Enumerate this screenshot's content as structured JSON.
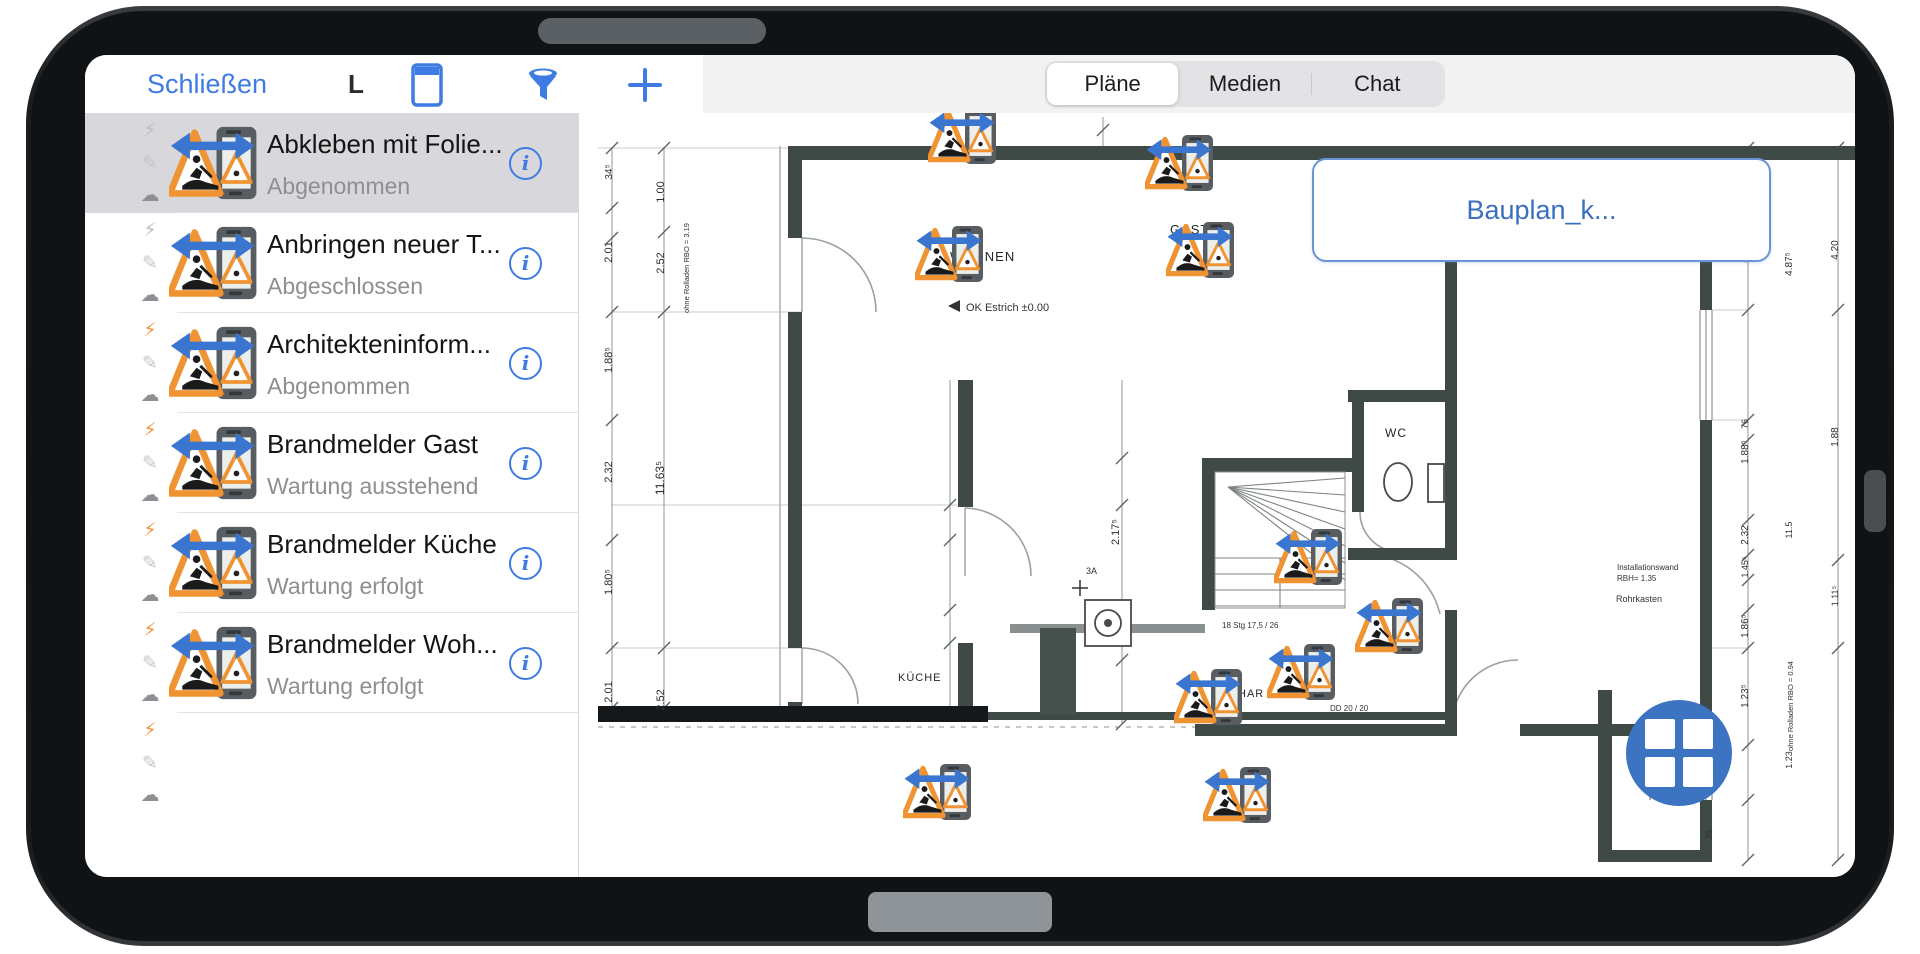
{
  "header": {
    "close_label": "Schließen",
    "context_label": "L",
    "tabs": [
      {
        "label": "Pläne",
        "selected": true
      },
      {
        "label": "Medien",
        "selected": false
      },
      {
        "label": "Chat",
        "selected": false
      }
    ]
  },
  "sidebar": {
    "items": [
      {
        "title": "Abkleben mit Folie...",
        "status": "Abgenommen",
        "selected": true,
        "flash": "gray",
        "partial": false
      },
      {
        "title": "Anbringen neuer T...",
        "status": "Abgeschlossen",
        "selected": false,
        "flash": "gray",
        "partial": false
      },
      {
        "title": "Architekteninform...",
        "status": "Abgenommen",
        "selected": false,
        "flash": "orange",
        "partial": false
      },
      {
        "title": "Brandmelder Gast",
        "status": "Wartung ausstehend",
        "selected": false,
        "flash": "orange",
        "partial": false
      },
      {
        "title": "Brandmelder Küche",
        "status": "Wartung erfolgt",
        "selected": false,
        "flash": "orange",
        "partial": false
      },
      {
        "title": "Brandmelder Woh...",
        "status": "Wartung erfolgt",
        "selected": false,
        "flash": "orange",
        "partial": false
      },
      {
        "title": "",
        "status": "",
        "selected": false,
        "flash": "orange",
        "partial": true
      }
    ]
  },
  "plan": {
    "callout_label": "Bauplan_k...",
    "room_labels": [
      {
        "t": "WOHNEN",
        "x": 950,
        "y": 261,
        "s": 13
      },
      {
        "t": "GAST",
        "x": 1170,
        "y": 234,
        "s": 13
      },
      {
        "t": "WC",
        "x": 1385,
        "y": 437,
        "s": 12
      },
      {
        "t": "KÜCHE",
        "x": 898,
        "y": 681,
        "s": 11
      },
      {
        "t": "HAR",
        "x": 1238,
        "y": 697,
        "s": 11
      }
    ],
    "annotations": [
      {
        "t": "OK Estrich ±0.00",
        "x": 966,
        "y": 311,
        "s": 11
      },
      {
        "t": "Installationswand",
        "x": 1617,
        "y": 570,
        "s": 8
      },
      {
        "t": "RBH= 1.35",
        "x": 1617,
        "y": 581,
        "s": 8
      },
      {
        "t": "Rohrkasten",
        "x": 1616,
        "y": 602,
        "s": 9
      },
      {
        "t": "DD 20 / 20",
        "x": 1330,
        "y": 711,
        "s": 8
      },
      {
        "t": "18 Stg 17,5 / 26",
        "x": 1222,
        "y": 628,
        "s": 8
      },
      {
        "t": "3A",
        "x": 1086,
        "y": 574,
        "s": 9
      }
    ],
    "dims": [
      {
        "t": "34⁵",
        "x": 612,
        "y": 172,
        "s": 10
      },
      {
        "t": "1.00",
        "x": 664,
        "y": 192,
        "s": 11
      },
      {
        "t": "2.01",
        "x": 612,
        "y": 252,
        "s": 11
      },
      {
        "t": "2.52",
        "x": 664,
        "y": 263,
        "s": 11
      },
      {
        "t": "ohne Rolladen RBO = 3.19",
        "x": 689,
        "y": 268,
        "s": 7.5
      },
      {
        "t": "1.88⁵",
        "x": 612,
        "y": 360,
        "s": 11
      },
      {
        "t": "2.32",
        "x": 612,
        "y": 472,
        "s": 11
      },
      {
        "t": "11.63⁵",
        "x": 664,
        "y": 478,
        "s": 12
      },
      {
        "t": "1.80⁵",
        "x": 612,
        "y": 582,
        "s": 11
      },
      {
        "t": "2.01",
        "x": 612,
        "y": 692,
        "s": 11
      },
      {
        "t": "2.52",
        "x": 664,
        "y": 700,
        "s": 11
      },
      {
        "t": "2.17⁵",
        "x": 1119,
        "y": 532,
        "s": 11
      },
      {
        "t": "17⁵",
        "x": 1748,
        "y": 176,
        "s": 10
      },
      {
        "t": "4.20",
        "x": 1748,
        "y": 252,
        "s": 11
      },
      {
        "t": "4.87⁵",
        "x": 1792,
        "y": 264,
        "s": 10
      },
      {
        "t": "4.20",
        "x": 1838,
        "y": 250,
        "s": 10
      },
      {
        "t": "76",
        "x": 1748,
        "y": 424,
        "s": 9
      },
      {
        "t": "1.88⁵",
        "x": 1748,
        "y": 452,
        "s": 10
      },
      {
        "t": "1.88",
        "x": 1838,
        "y": 437,
        "s": 10
      },
      {
        "t": "11.5",
        "x": 1792,
        "y": 530,
        "s": 9
      },
      {
        "t": "2.32",
        "x": 1748,
        "y": 535,
        "s": 10
      },
      {
        "t": "1.45⁵",
        "x": 1748,
        "y": 567,
        "s": 9
      },
      {
        "t": "1.86⁵",
        "x": 1748,
        "y": 626,
        "s": 10
      },
      {
        "t": "1.11⁵",
        "x": 1838,
        "y": 596,
        "s": 9
      },
      {
        "t": "1.23⁵",
        "x": 1748,
        "y": 696,
        "s": 10
      },
      {
        "t": "ohne Rolladen RBO = 0.94",
        "x": 1793,
        "y": 706,
        "s": 7.5
      },
      {
        "t": "35",
        "x": 1712,
        "y": 835,
        "s": 9
      },
      {
        "t": "1.23",
        "x": 1792,
        "y": 760,
        "s": 9
      }
    ],
    "markers": [
      {
        "x": 965,
        "y": 136
      },
      {
        "x": 1182,
        "y": 163
      },
      {
        "x": 952,
        "y": 254
      },
      {
        "x": 1203,
        "y": 250
      },
      {
        "x": 1311,
        "y": 557
      },
      {
        "x": 1304,
        "y": 672
      },
      {
        "x": 1211,
        "y": 697
      },
      {
        "x": 1392,
        "y": 626
      },
      {
        "x": 940,
        "y": 792
      },
      {
        "x": 1240,
        "y": 795
      }
    ],
    "geometry": {
      "walls": [
        [
          788,
          146,
          1068,
          14
        ],
        [
          788,
          146,
          14,
          92
        ],
        [
          788,
          312,
          14,
          336
        ],
        [
          788,
          702,
          14,
          16
        ],
        [
          958,
          380,
          15,
          127
        ],
        [
          958,
          643,
          15,
          75
        ],
        [
          1202,
          458,
          150,
          14
        ],
        [
          1202,
          458,
          13,
          152
        ],
        [
          1348,
          390,
          109,
          12
        ],
        [
          1352,
          390,
          12,
          122
        ],
        [
          1348,
          548,
          109,
          12
        ],
        [
          1445,
          148,
          12,
          412
        ],
        [
          1445,
          610,
          12,
          126
        ],
        [
          1700,
          148,
          12,
          162
        ],
        [
          1700,
          420,
          12,
          325
        ],
        [
          1700,
          800,
          12,
          62
        ],
        [
          1195,
          724,
          257,
          12
        ],
        [
          1520,
          724,
          192,
          12
        ],
        [
          1598,
          690,
          14,
          172
        ],
        [
          1598,
          850,
          114,
          12
        ]
      ],
      "black": [
        [
          598,
          706,
          390,
          16
        ]
      ],
      "darkthin": [
        [
          988,
          712,
          457,
          8
        ]
      ],
      "grays": [
        [
          1010,
          624,
          195,
          9
        ]
      ],
      "cabinet": [
        [
          1040,
          628,
          36,
          86
        ]
      ],
      "dimlines": [
        {
          "x": 612,
          "y1": 148,
          "y2": 708,
          "ticks": [
            148,
            208,
            238,
            312,
            420,
            540,
            648,
            708
          ]
        },
        {
          "x": 664,
          "y1": 148,
          "y2": 708,
          "ticks": [
            148,
            232,
            312,
            648,
            708
          ]
        },
        {
          "x": 950,
          "y1": 380,
          "y2": 716,
          "ticks": [
            505,
            540,
            610,
            643
          ]
        },
        {
          "x": 1122,
          "y1": 380,
          "y2": 724,
          "ticks": [
            458,
            505,
            610,
            660,
            724
          ]
        },
        {
          "x": 1103,
          "y1": 117,
          "y2": 146,
          "ticks": [
            130
          ]
        },
        {
          "x": 1748,
          "y1": 148,
          "y2": 860,
          "ticks": [
            148,
            162,
            310,
            420,
            440,
            520,
            555,
            580,
            610,
            648,
            745,
            800,
            860
          ]
        },
        {
          "x": 1838,
          "y1": 148,
          "y2": 860,
          "ticks": [
            148,
            310,
            560,
            648,
            860
          ]
        }
      ],
      "ext": [
        [
          612,
          505,
          958,
          505
        ],
        [
          612,
          312,
          802,
          312
        ],
        [
          612,
          648,
          802,
          648
        ],
        [
          598,
          148,
          788,
          148
        ],
        [
          1712,
          310,
          1748,
          310
        ],
        [
          1712,
          420,
          1748,
          420
        ],
        [
          1712,
          648,
          1748,
          648
        ]
      ],
      "dashed": [
        598,
        727,
        1195,
        727
      ],
      "arcs": [
        "M 876 312 A 74 74 0 0 0 802 238",
        "M 858 704 A 56 56 0 0 0 802 648",
        "M 1031 576 A 68 68 0 0 0 965 508",
        "M 1440 614 A 78 78 0 0 0 1364 554",
        "M 1650 800 A 52 52 0 0 1 1702 748",
        "M 1518 660 A 66 66 0 0 0 1452 724",
        "M 1398 552 A 40 40 0 0 1 1360 512"
      ],
      "leaves": [
        [
          802,
          238,
          802,
          312
        ],
        [
          802,
          648,
          802,
          704
        ],
        [
          965,
          508,
          965,
          576
        ],
        [
          1452,
          658,
          1452,
          724
        ]
      ],
      "windows": [
        [
          1700,
          310,
          110
        ],
        [
          1700,
          745,
          55
        ]
      ],
      "stairs": {
        "x": 1215,
        "y": 472,
        "w": 130,
        "h": 136,
        "px": 1228,
        "py": 487
      },
      "oven": {
        "x": 1085,
        "y": 600,
        "s": 46
      },
      "toilet": {
        "cx": 1398,
        "cy": 482
      },
      "cross": {
        "x": 1080,
        "y": 588
      }
    }
  },
  "colors": {
    "accent": "#3e7ce4",
    "marker_blue": "#3a76d0",
    "orange": "#f09433",
    "wall": "#3f4a47",
    "status_gray": "#8e8e93",
    "grid_button": "#3d74c2"
  }
}
